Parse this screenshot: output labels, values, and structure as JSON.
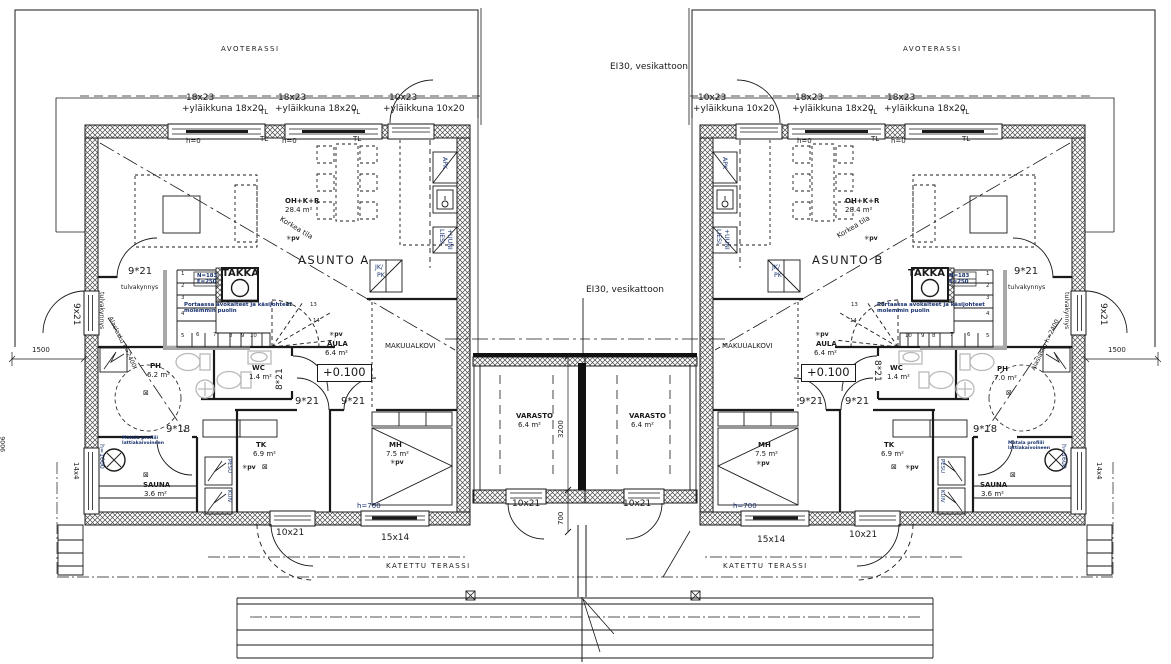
{
  "site": {
    "avoterassi": "AVOTERASSI",
    "katettu_terassi": "KATETTU TERASSI",
    "ei30": "EI30, vesikattoon",
    "dim_1500": "1500",
    "dim_3200": "3200",
    "dim_700": "700",
    "dim_side": "9006"
  },
  "windows": {
    "w18x23": "18x23",
    "w18x23_top": "+yläikkuna 18x20",
    "w10x23": "10x23",
    "w10x23_top": "+yläikkuna 10x20",
    "tl": "TL",
    "h0": "h=0",
    "w15x14": "15x14",
    "w14x4": "14x4",
    "h700": "h=700",
    "h1600": "h=1600"
  },
  "doors": {
    "d9x21": "9*21",
    "d9x21_side": "9x21",
    "d8x21": "8*21",
    "d9x18": "9*18",
    "d10x21": "10x21",
    "tulvakynnys": "tulvakynnys"
  },
  "rooms": {
    "oh": "OH+K+R",
    "oh_area": "28.4  m²",
    "korkea": "Korkea  tila",
    "ph": "PH",
    "wc": "WC",
    "wc_area": "1.4  m²",
    "aula": "AULA",
    "aula_area": "6.4  m²",
    "makuualkovi": "MAKUUALKOVI",
    "tk": "TK",
    "tk_area": "6.9  m²",
    "mh": "MH",
    "mh_area": "7.5  m²",
    "sauna": "SAUNA",
    "sauna_area": "3.6  m²",
    "varasto": "VARASTO",
    "varasto_area": "6.4  m²",
    "level": "+0.100"
  },
  "units": {
    "a": {
      "name": "ASUNTO  A",
      "ph_area": "6.2  m²"
    },
    "b": {
      "name": "ASUNTO  B",
      "ph_area": "7.0  m²"
    }
  },
  "fireplace": {
    "label": "TAKKA",
    "n": "N=183",
    "e": "E=250"
  },
  "stairs": {
    "note1": "Portaassa avokaiteet ja käsijohteet",
    "note2": "molemmin puolin",
    "nums": [
      "1",
      "2",
      "3",
      "4",
      "5",
      "6",
      "7",
      "8",
      "9",
      "10",
      "12",
      "13",
      "14"
    ]
  },
  "notes": {
    "alaslasku": "Alaslasku  h=2400",
    "matala1": "Matala profiili",
    "matala2": "lattiakaivoineen",
    "pv": "pv"
  },
  "appliances": {
    "apk": "APK",
    "liesi": "LIESI",
    "uuni": "+UUNI",
    "jk": "JK/",
    "pk": "PK",
    "pesu": "PESU",
    "kuiv": "KUIV"
  },
  "symbols": {
    "pv_icon": "✳",
    "lamp_icon": "⊠"
  },
  "colors": {
    "line": "#1a1a1a",
    "annotation": "#17316e",
    "fixture": "#b9b9b9"
  }
}
